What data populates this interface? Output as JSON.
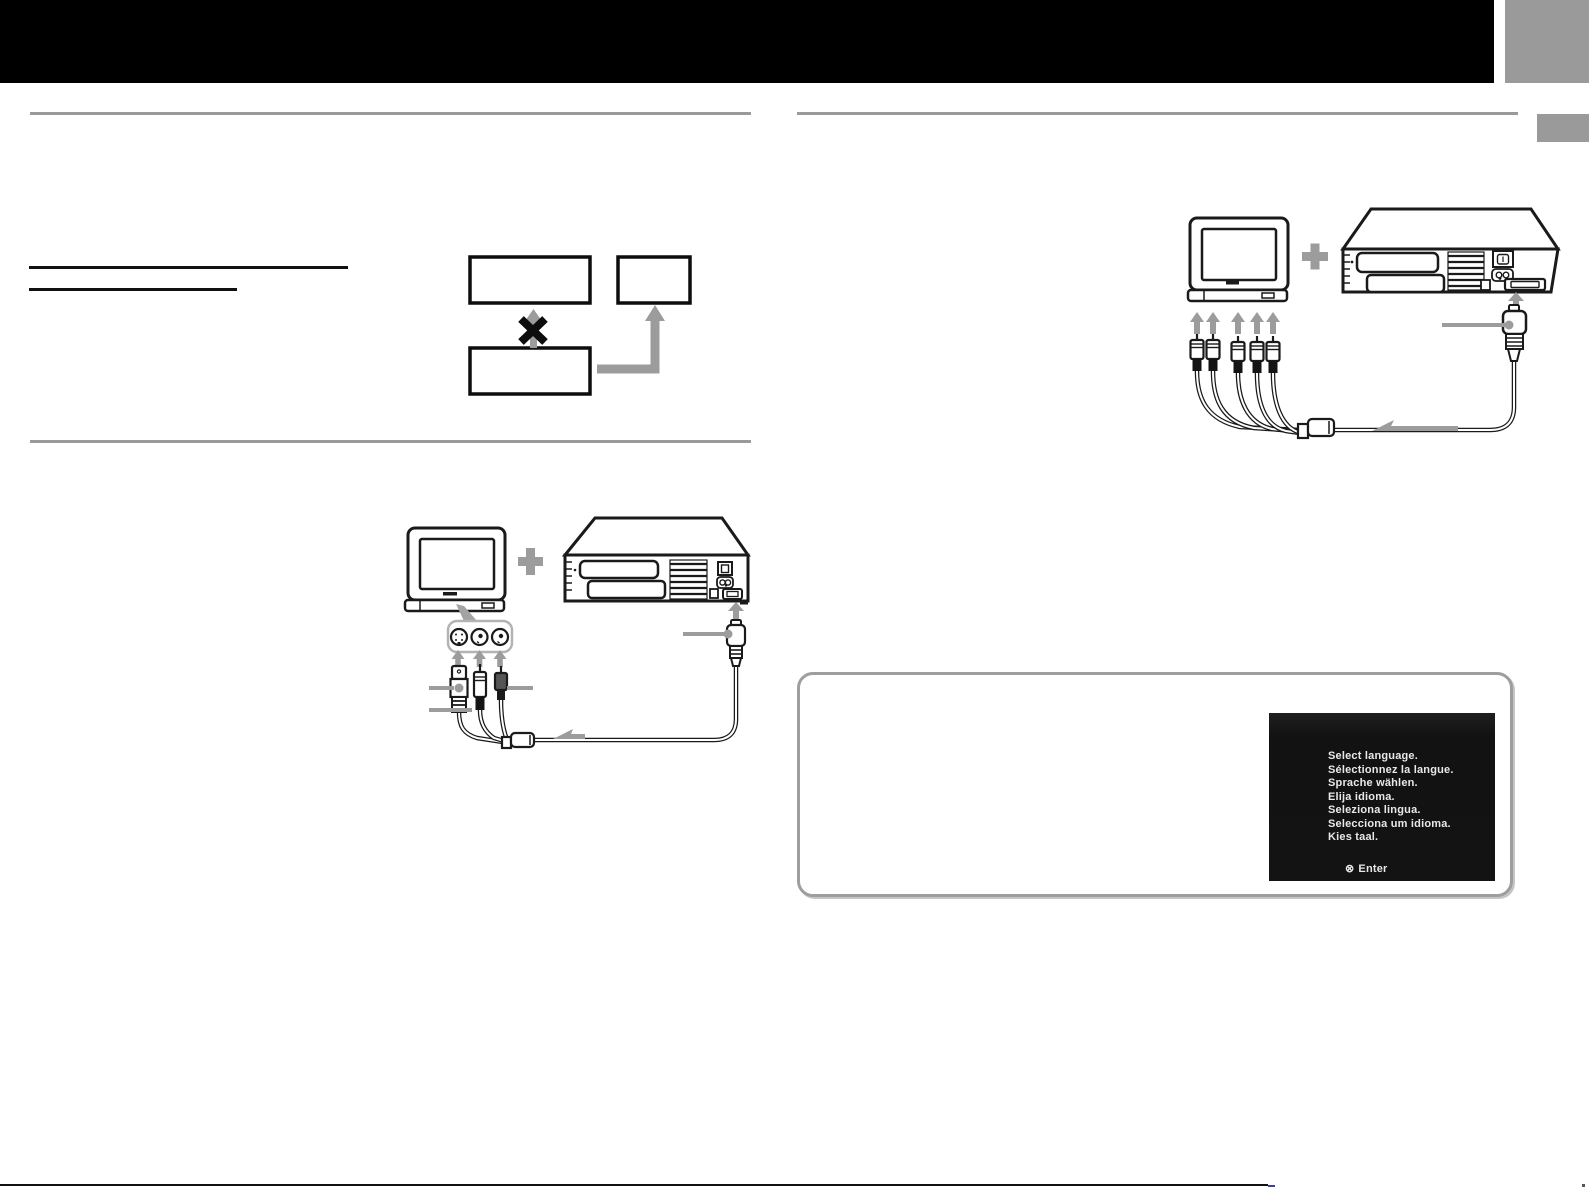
{
  "colors": {
    "header_bar": "#000000",
    "accent_gray": "#9c9c9c",
    "rule_gray": "#9a9a9a",
    "line_black": "#111111",
    "screen_bg": "#131313",
    "screen_text": "#e8e8e8"
  },
  "hint_screen": {
    "lines": [
      "Select language.",
      "Sélectionnez la langue.",
      "Sprache wählen.",
      "Elija idioma.",
      "Seleziona lingua.",
      "Selecciona um idioma.",
      "Kies taal."
    ],
    "enter": {
      "symbol": "⊗",
      "label": "Enter"
    }
  }
}
